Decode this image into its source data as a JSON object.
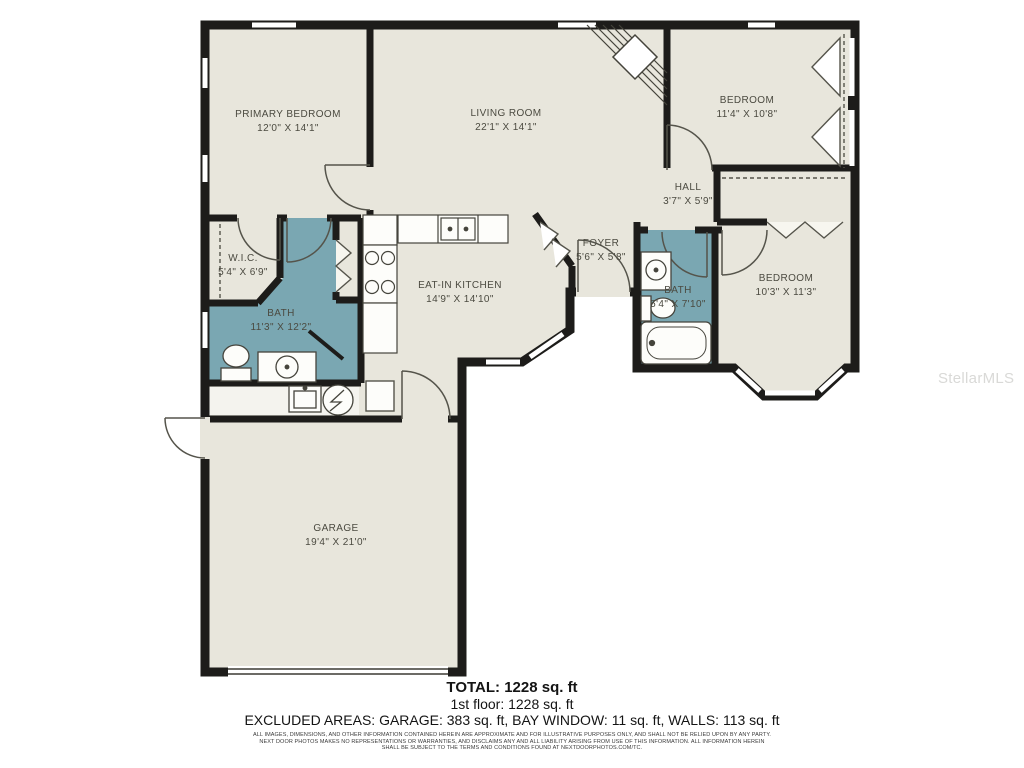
{
  "plan": {
    "rooms": {
      "primary_bedroom": {
        "name": "PRIMARY BEDROOM",
        "dims": "12'0\" X 14'1\""
      },
      "living_room": {
        "name": "LIVING ROOM",
        "dims": "22'1\" X 14'1\""
      },
      "bedroom_top": {
        "name": "BEDROOM",
        "dims": "11'4\" X 10'8\""
      },
      "hall": {
        "name": "HALL",
        "dims": "3'7\" X 5'9\""
      },
      "wic": {
        "name": "W.I.C.",
        "dims": "5'4\" X 6'9\""
      },
      "bath_main": {
        "name": "BATH",
        "dims": "11'3\" X 12'2\""
      },
      "kitchen": {
        "name": "EAT-IN KITCHEN",
        "dims": "14'9\" X 14'10\""
      },
      "foyer": {
        "name": "FOYER",
        "dims": "5'6\" X 5'8\""
      },
      "bath_hall": {
        "name": "BATH",
        "dims": "5'4\" X 7'10\""
      },
      "bedroom_right": {
        "name": "BEDROOM",
        "dims": "10'3\" X 11'3\""
      },
      "garage": {
        "name": "GARAGE",
        "dims": "19'4\" X 21'0\""
      }
    },
    "colors": {
      "floor": "#e8e6dc",
      "bath_floor": "#7aa7b2",
      "wall": "#1d1c1a",
      "label": "#4b4a40"
    }
  },
  "summary": {
    "total": "TOTAL: 1228 sq. ft",
    "first_floor": "1st floor: 1228 sq. ft",
    "excluded": "EXCLUDED AREAS: GARAGE: 383 sq. ft, BAY WINDOW: 11 sq. ft, WALLS: 113 sq. ft"
  },
  "disclaimer": {
    "line1": "ALL IMAGES, DIMENSIONS, AND OTHER INFORMATION CONTAINED HEREIN ARE APPROXIMATE AND FOR ILLUSTRATIVE PURPOSES ONLY, AND SHALL NOT BE RELIED UPON BY ANY PARTY.",
    "line2": "NEXT DOOR PHOTOS MAKES NO REPRESENTATIONS OR WARRANTIES, AND DISCLAIMS ANY AND ALL LIABILITY ARISING FROM USE OF THIS INFORMATION. ALL INFORMATION HEREIN",
    "line3": "SHALL BE SUBJECT TO THE TERMS AND CONDITIONS FOUND AT NEXTDOORPHOTOS.COM/TC."
  },
  "watermark": "StellarMLS"
}
